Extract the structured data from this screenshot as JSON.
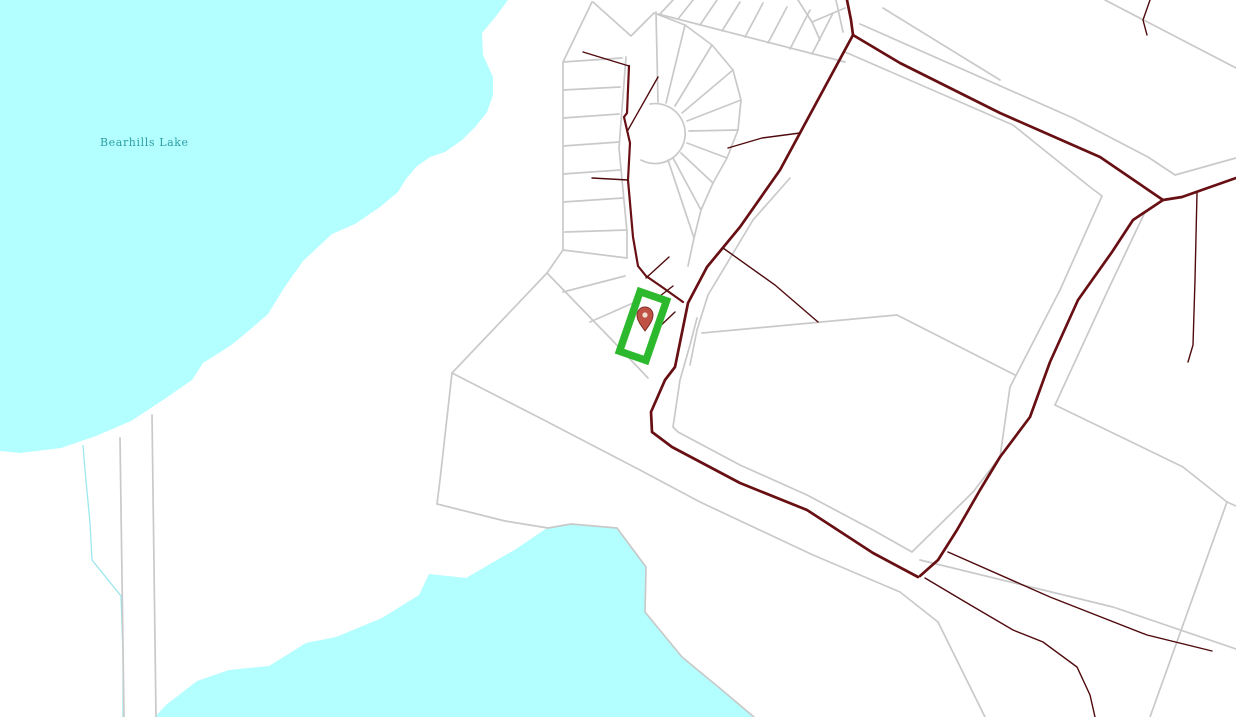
{
  "map": {
    "labels": [
      {
        "text": "Bearhills Lake",
        "type": "water-label"
      }
    ],
    "marker": {
      "type": "location-pin"
    },
    "highlight": {
      "shape": "rotated-rectangle-outline"
    },
    "colors": {
      "background": "#ffffff",
      "water": "#b3feff",
      "stream": "#9be8ef",
      "water_label": "#2e9fa5",
      "parcel_line": "#c9c9c9",
      "road_major": "#670f13",
      "road_minor": "#4f0b0e",
      "highlight_green": "#2db92d",
      "marker_fill": "#bf5145",
      "marker_outline": "#7e2f27",
      "marker_dot": "#f0ddd0"
    }
  }
}
